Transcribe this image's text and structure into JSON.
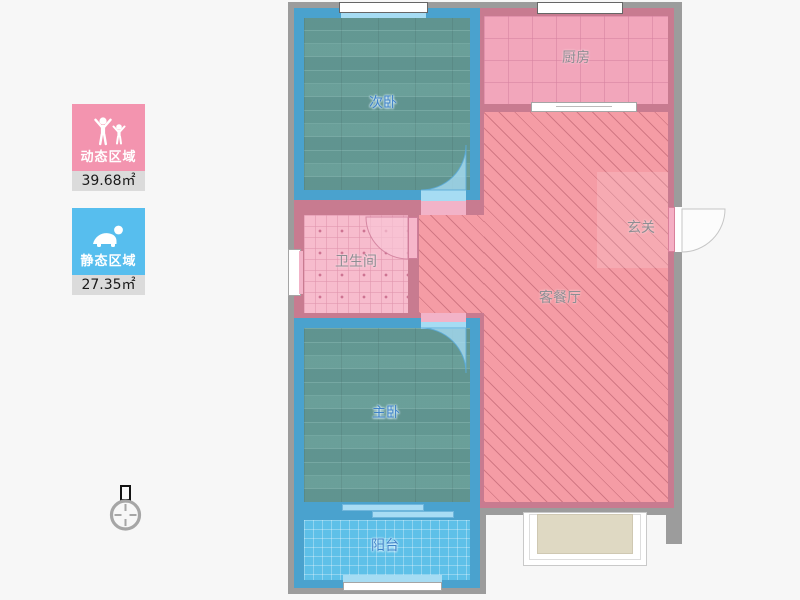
{
  "legend": {
    "items": [
      {
        "id": "dynamic-area",
        "label": "动态区域",
        "value": "39.68",
        "unit": "㎡",
        "display": "39.68㎡",
        "color": "#F394AF",
        "icon": "people-arms-raised-icon"
      },
      {
        "id": "static-area",
        "label": "静态区域",
        "value": "27.35",
        "unit": "㎡",
        "display": "27.35㎡",
        "color": "#57BEEE",
        "icon": "person-crawling-icon"
      }
    ]
  },
  "floorplan": {
    "rooms": [
      {
        "id": "secondary-bedroom",
        "label": "次卧",
        "floor": "wood"
      },
      {
        "id": "kitchen",
        "label": "厨房",
        "floor": "tile"
      },
      {
        "id": "bathroom",
        "label": "卫生间",
        "floor": "tile"
      },
      {
        "id": "living-dining",
        "label": "客餐厅",
        "floor": "diagonal-hatch"
      },
      {
        "id": "entry-hall",
        "label": "玄关",
        "floor": "diagonal-hatch"
      },
      {
        "id": "master-bedroom",
        "label": "主卧",
        "floor": "wood"
      },
      {
        "id": "balcony",
        "label": "阳台",
        "floor": "tile"
      }
    ],
    "symbols": {
      "compass": "north-compass-icon",
      "door_types": [
        "swing-door-arc",
        "entry-door-arc",
        "sliding-door",
        "bay-window",
        "window"
      ]
    },
    "colors": {
      "bedroom_wall": "#4AA2CE",
      "pink_wall": "#C87B90",
      "outer_wall": "#9C9C9C",
      "living_fill": "#F59CA5",
      "kitchen_fill": "#F2A6BB",
      "bathroom_fill": "#F7BCCD",
      "balcony_fill": "#5EC0E8",
      "wood_fill": "#6CA29C",
      "door_arc_fill": "#A6DCF3"
    }
  }
}
